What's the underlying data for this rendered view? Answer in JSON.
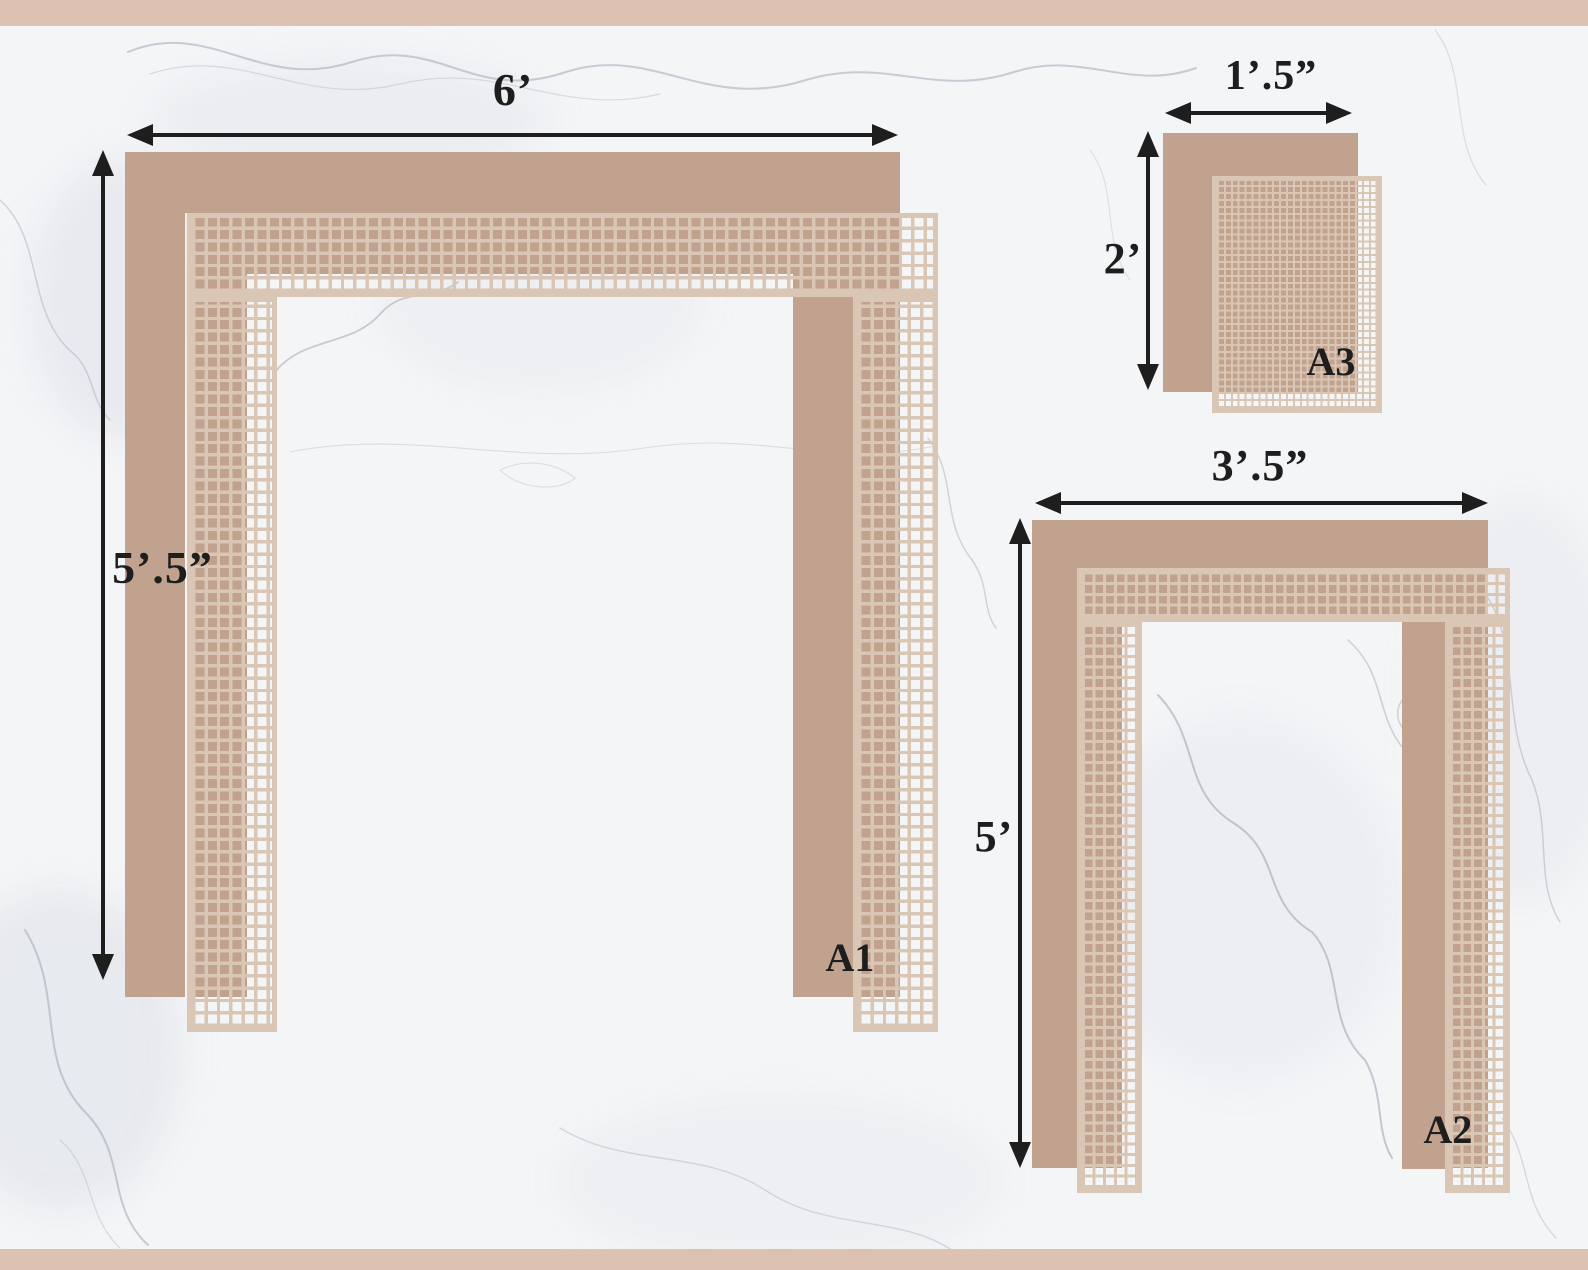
{
  "colors": {
    "border_strip": "#DDC2B1",
    "tile_solid": "#C0A28E",
    "mesh_grout": "#DAC6B4",
    "dimension_ink": "#1E1E1E",
    "marble_base": "#F4F5F7",
    "marble_vein": "#9AA1AF"
  },
  "areas": [
    {
      "id": "A1",
      "label": "A1",
      "width_label": "6’",
      "height_label": "5’.5”"
    },
    {
      "id": "A2",
      "label": "A2",
      "width_label": "3’.5”",
      "height_label": "5’"
    },
    {
      "id": "A3",
      "label": "A3",
      "width_label": "1’.5”",
      "height_label": "2’"
    }
  ]
}
